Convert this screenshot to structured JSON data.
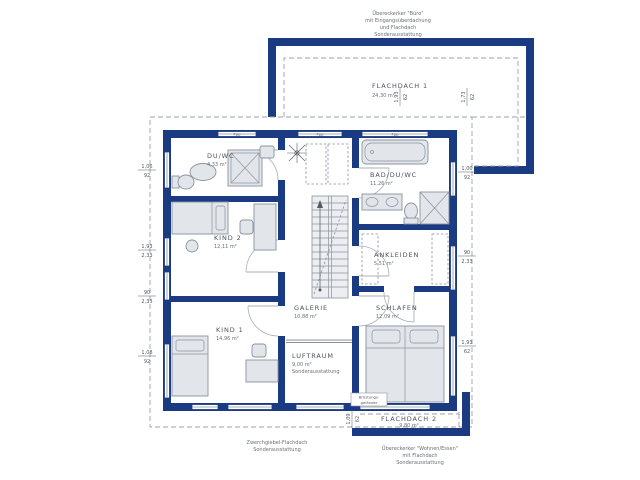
{
  "plan": {
    "annotation_top": {
      "l1": "Übereckerker \"Büro\"",
      "l2": "mit Eingangsüberdachung",
      "l3": "und Flachdach",
      "l4": "Sonderausstattung"
    },
    "annotation_bottom_center": {
      "l1": "Zwerchgiebel-Flachdach",
      "l2": "Sonderausstattung"
    },
    "annotation_bottom_right": {
      "l1": "Übereckerker \"Wohnen/Essen\"",
      "l2": "mit Flachdach",
      "l3": "Sonderausstattung"
    },
    "railing_label": {
      "l1": "Brüstungs-",
      "l2": "geländer"
    },
    "rooms": {
      "flachdach1": {
        "name": "FLACHDACH 1",
        "area": "24,30 m²"
      },
      "duwc": {
        "name": "DU/WC",
        "area": "4,33 m²"
      },
      "bad": {
        "name": "BAD/DU/WC",
        "area": "11,26 m²"
      },
      "kind2": {
        "name": "KIND 2",
        "area": "12,11 m²"
      },
      "ankleiden": {
        "name": "ANKLEIDEN",
        "area": "5,51 m²"
      },
      "galerie": {
        "name": "GALERIE",
        "area": "10,88 m²"
      },
      "schlafen": {
        "name": "SCHLAFEN",
        "area": "12,09 m²"
      },
      "kind1": {
        "name": "KIND 1",
        "area": "14,96 m²"
      },
      "luftraum": {
        "name": "LUFTRAUM",
        "area": "9,00 m²",
        "note": "Sonderausstattung"
      },
      "flachdach2": {
        "name": "FLACHDACH 2",
        "area": "9,80 m²"
      }
    },
    "dimensions": {
      "left": [
        {
          "a": "1,06",
          "b": "92"
        },
        {
          "a": "1,93",
          "b": "2,33"
        },
        {
          "a": "90",
          "b": "2,33"
        },
        {
          "a": "1,08",
          "b": "92"
        }
      ],
      "right": [
        {
          "a": "1,00",
          "b": "92"
        },
        {
          "a": "90",
          "b": "2,33"
        },
        {
          "a": "1,93",
          "b": "62"
        }
      ],
      "top": [
        {
          "a": "1,93",
          "b": "62"
        },
        {
          "a": "1,73",
          "b": "62"
        }
      ],
      "bottom": [
        {
          "a": "1,09",
          "b": "62"
        }
      ]
    },
    "window_label": "Fpp"
  },
  "colors": {
    "wall_navy": "#1a3a82",
    "furniture_fill": "#e2e6ea",
    "line_gray": "#8b939e",
    "text_gray": "#555a60"
  }
}
